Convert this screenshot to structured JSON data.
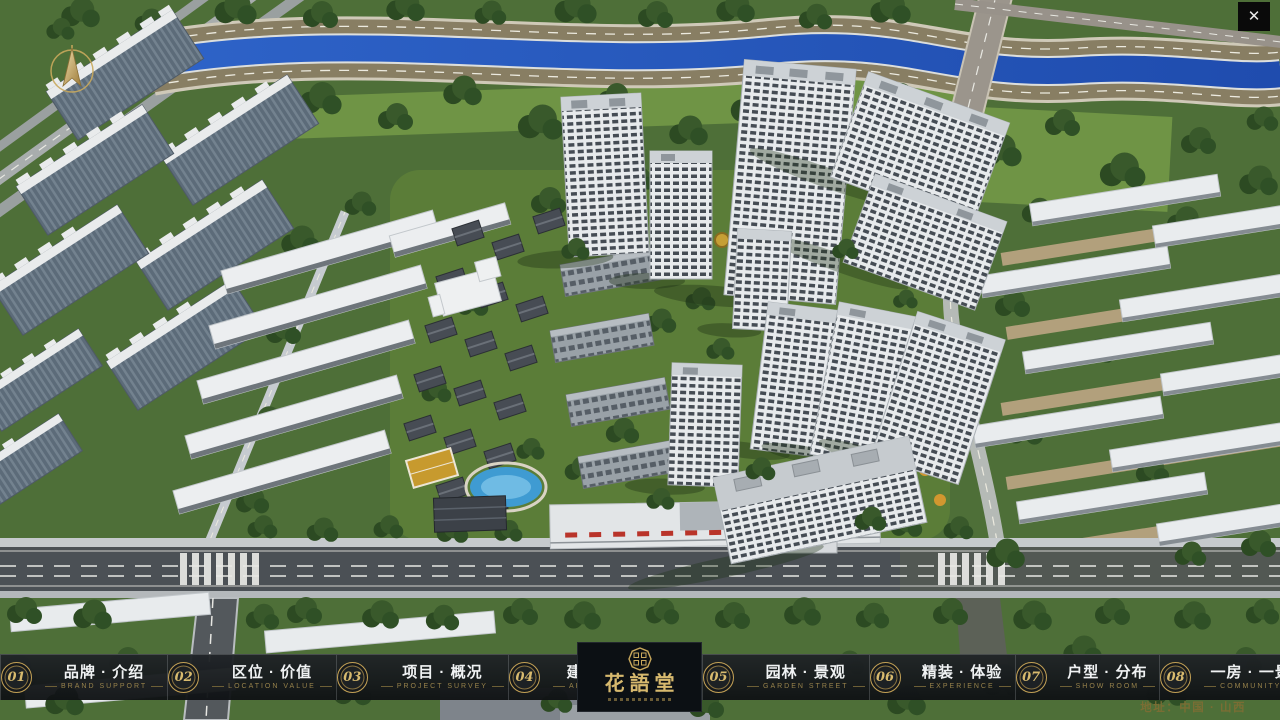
{
  "window": {
    "close_label": "✕"
  },
  "nav": {
    "items": [
      {
        "num": "01",
        "zh": "品牌 · 介绍",
        "en": "BRAND SUPPORT"
      },
      {
        "num": "02",
        "zh": "区位 · 价值",
        "en": "LOCATION VALUE"
      },
      {
        "num": "03",
        "zh": "项目 · 概况",
        "en": "PROJECT SURVEY"
      },
      {
        "num": "04",
        "zh": "建筑 · 鉴赏",
        "en": "APPRECIATION"
      },
      {
        "num": "05",
        "zh": "园林 · 景观",
        "en": "GARDEN STREET"
      },
      {
        "num": "06",
        "zh": "精装 · 体验",
        "en": "EXPERIENCE"
      },
      {
        "num": "07",
        "zh": "户型 · 分布",
        "en": "SHOW ROOM"
      },
      {
        "num": "08",
        "zh": "一房 · 一景",
        "en": "COMMUNITY"
      }
    ]
  },
  "logo": {
    "title": "花語堂"
  },
  "footer": {
    "address": "地址：中国 · 山西"
  },
  "colors": {
    "accent_gold": "#c9a85c",
    "nav_background": "#1a1e21",
    "river_blue": "#2b55c0",
    "close_button_bg": "#0a0a0a"
  }
}
